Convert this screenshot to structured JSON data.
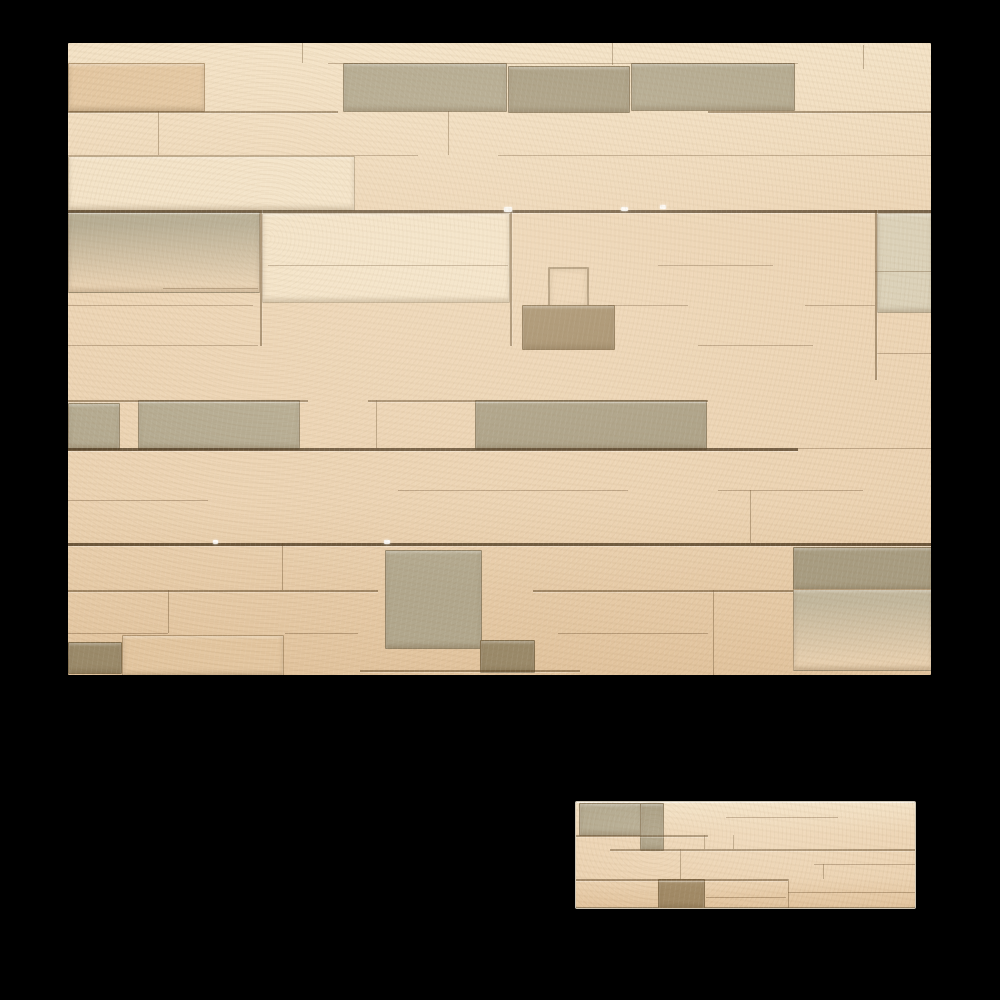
{
  "page": {
    "background_color": "#000000"
  },
  "palette": {
    "background": "#000000",
    "base": "#ecd3b2",
    "base_light": "#f4e3c7",
    "base_shade": "#e2c49e",
    "light": "#f3e2c6",
    "tan": "#e4c7a1",
    "grey1": "#c3b89e",
    "grey2": "#b2a88e",
    "grey3": "#a89d82",
    "lightgrey": "#d9cfb6",
    "dark1": "#a18a66",
    "dark2": "#9a8a6a",
    "seam": "#5f4626",
    "speck": "#ffffff"
  },
  "images": [
    {
      "name": "stone-wall-large-image",
      "alt": "Beige stacked stone cladding wall, full wall view",
      "x": 68,
      "y": 43,
      "w": 863,
      "h": 632,
      "framed": false,
      "stones": [
        {
          "x": 0,
          "y": 20,
          "w": 135,
          "h": 47,
          "c": "tan"
        },
        {
          "x": 275,
          "y": 20,
          "w": 162,
          "h": 47,
          "c": "grey2"
        },
        {
          "x": 440,
          "y": 23,
          "w": 120,
          "h": 45,
          "c": "grey3",
          "tex": true
        },
        {
          "x": 563,
          "y": 20,
          "w": 162,
          "h": 46,
          "c": "grey2"
        },
        {
          "x": 0,
          "y": 113,
          "w": 285,
          "h": 53,
          "c": "light"
        },
        {
          "x": 0,
          "y": 168,
          "w": 190,
          "h": 80,
          "c": "grey2",
          "fade": "bottom"
        },
        {
          "x": 194,
          "y": 170,
          "w": 246,
          "h": 88,
          "c": "light"
        },
        {
          "x": 809,
          "y": 170,
          "w": 54,
          "h": 98,
          "c": "lightgrey"
        },
        {
          "x": 480,
          "y": 224,
          "w": 37,
          "h": 38,
          "c": "none"
        },
        {
          "x": 454,
          "y": 262,
          "w": 91,
          "h": 43,
          "c": "dark1",
          "tex": true
        },
        {
          "x": 0,
          "y": 360,
          "w": 50,
          "h": 45,
          "c": "grey2"
        },
        {
          "x": 70,
          "y": 357,
          "w": 160,
          "h": 48,
          "c": "grey2",
          "tex": true
        },
        {
          "x": 407,
          "y": 357,
          "w": 230,
          "h": 48,
          "c": "grey3",
          "tex": true
        },
        {
          "x": 317,
          "y": 507,
          "w": 95,
          "h": 97,
          "c": "grey2",
          "tex": true
        },
        {
          "x": 725,
          "y": 504,
          "w": 138,
          "h": 42,
          "c": "grey3",
          "tex": true
        },
        {
          "x": 725,
          "y": 546,
          "w": 138,
          "h": 80,
          "c": "grey1",
          "fade": "bottom"
        },
        {
          "x": 54,
          "y": 592,
          "w": 160,
          "h": 40,
          "c": "tan"
        },
        {
          "x": 0,
          "y": 599,
          "w": 52,
          "h": 30,
          "c": "dark2"
        },
        {
          "x": 412,
          "y": 597,
          "w": 53,
          "h": 31,
          "c": "dark2"
        }
      ],
      "seams": [
        {
          "y": 20,
          "s": 1,
          "segs": [
            [
              260,
              730
            ]
          ]
        },
        {
          "y": 68,
          "s": 2,
          "segs": [
            [
              0,
              270
            ],
            [
              640,
              863
            ]
          ]
        },
        {
          "y": 112,
          "s": 1,
          "segs": [
            [
              0,
              350
            ],
            [
              430,
              863
            ]
          ]
        },
        {
          "y": 167,
          "s": 3,
          "segs": [
            [
              0,
              863
            ]
          ]
        },
        {
          "y": 222,
          "s": 1,
          "segs": [
            [
              200,
              440
            ],
            [
              590,
              705
            ]
          ]
        },
        {
          "y": 228,
          "s": 1,
          "segs": [
            [
              807,
              863
            ]
          ]
        },
        {
          "y": 245,
          "s": 1,
          "segs": [
            [
              95,
              190
            ]
          ]
        },
        {
          "y": 262,
          "s": 1,
          "segs": [
            [
              0,
              185
            ],
            [
              540,
              620
            ],
            [
              737,
              807
            ]
          ]
        },
        {
          "y": 302,
          "s": 1,
          "segs": [
            [
              0,
              190
            ],
            [
              630,
              745
            ]
          ]
        },
        {
          "y": 310,
          "s": 1,
          "segs": [
            [
              809,
              863
            ]
          ]
        },
        {
          "y": 357,
          "s": 2,
          "segs": [
            [
              0,
              240
            ],
            [
              300,
              640
            ]
          ]
        },
        {
          "y": 405,
          "s": 3,
          "segs": [
            [
              0,
              730
            ]
          ]
        },
        {
          "y": 405,
          "s": 1,
          "segs": [
            [
              730,
              863
            ]
          ]
        },
        {
          "y": 447,
          "s": 1,
          "segs": [
            [
              330,
              560
            ],
            [
              650,
              795
            ]
          ]
        },
        {
          "y": 457,
          "s": 1,
          "segs": [
            [
              0,
              140
            ]
          ]
        },
        {
          "y": 500,
          "s": 3,
          "segs": [
            [
              0,
              863
            ]
          ]
        },
        {
          "y": 547,
          "s": 2,
          "segs": [
            [
              0,
              310
            ],
            [
              465,
              725
            ]
          ]
        },
        {
          "y": 590,
          "s": 1,
          "segs": [
            [
              0,
              100
            ],
            [
              217,
              290
            ],
            [
              490,
              640
            ]
          ]
        },
        {
          "y": 627,
          "s": 2,
          "segs": [
            [
              292,
              512
            ]
          ]
        }
      ],
      "joints": [
        {
          "x": 234,
          "y": 0,
          "h": 20,
          "s": 1
        },
        {
          "x": 544,
          "y": 0,
          "h": 22,
          "s": 1
        },
        {
          "x": 795,
          "y": 2,
          "h": 24,
          "s": 1
        },
        {
          "x": 90,
          "y": 68,
          "h": 44,
          "s": 1
        },
        {
          "x": 380,
          "y": 68,
          "h": 44,
          "s": 1
        },
        {
          "x": 192,
          "y": 167,
          "h": 136,
          "s": 2
        },
        {
          "x": 442,
          "y": 167,
          "h": 136,
          "s": 2
        },
        {
          "x": 807,
          "y": 167,
          "h": 170,
          "s": 2
        },
        {
          "x": 308,
          "y": 357,
          "h": 48,
          "s": 1
        },
        {
          "x": 682,
          "y": 447,
          "h": 53,
          "s": 1
        },
        {
          "x": 214,
          "y": 500,
          "h": 47,
          "s": 1
        },
        {
          "x": 100,
          "y": 547,
          "h": 43,
          "s": 1
        },
        {
          "x": 645,
          "y": 547,
          "h": 85,
          "s": 1
        }
      ],
      "specks": [
        {
          "x": 436,
          "y": 164,
          "w": 8,
          "h": 5
        },
        {
          "x": 553,
          "y": 164,
          "w": 7,
          "h": 4
        },
        {
          "x": 592,
          "y": 162,
          "w": 6,
          "h": 4
        },
        {
          "x": 316,
          "y": 497,
          "w": 6,
          "h": 4
        },
        {
          "x": 145,
          "y": 497,
          "w": 5,
          "h": 4
        }
      ]
    },
    {
      "name": "stone-panel-small-image",
      "alt": "Single beige stacked stone cladding panel",
      "x": 576,
      "y": 802,
      "w": 339,
      "h": 106,
      "framed": true,
      "stones": [
        {
          "x": 3,
          "y": 1,
          "w": 62,
          "h": 31,
          "c": "grey2",
          "tex": true
        },
        {
          "x": 64,
          "y": 1,
          "w": 22,
          "h": 46,
          "c": "grey3"
        },
        {
          "x": 82,
          "y": 77,
          "w": 45,
          "h": 28,
          "c": "dark1",
          "tex": true
        }
      ],
      "seams": [
        {
          "y": 15,
          "s": 1,
          "segs": [
            [
              150,
              262
            ]
          ]
        },
        {
          "y": 33,
          "s": 2,
          "segs": [
            [
              0,
              132
            ]
          ]
        },
        {
          "y": 47,
          "s": 2,
          "segs": [
            [
              34,
              339
            ]
          ]
        },
        {
          "y": 62,
          "s": 1,
          "segs": [
            [
              238,
              339
            ]
          ]
        },
        {
          "y": 77,
          "s": 2,
          "segs": [
            [
              0,
              212
            ]
          ]
        },
        {
          "y": 90,
          "s": 1,
          "segs": [
            [
              212,
              339
            ]
          ]
        },
        {
          "y": 95,
          "s": 1,
          "segs": [
            [
              130,
              210
            ]
          ]
        }
      ],
      "joints": [
        {
          "x": 104,
          "y": 47,
          "h": 30,
          "s": 1
        },
        {
          "x": 128,
          "y": 33,
          "h": 14,
          "s": 1
        },
        {
          "x": 157,
          "y": 33,
          "h": 14,
          "s": 1
        },
        {
          "x": 212,
          "y": 77,
          "h": 29,
          "s": 1
        },
        {
          "x": 247,
          "y": 62,
          "h": 15,
          "s": 1
        }
      ],
      "specks": []
    }
  ]
}
